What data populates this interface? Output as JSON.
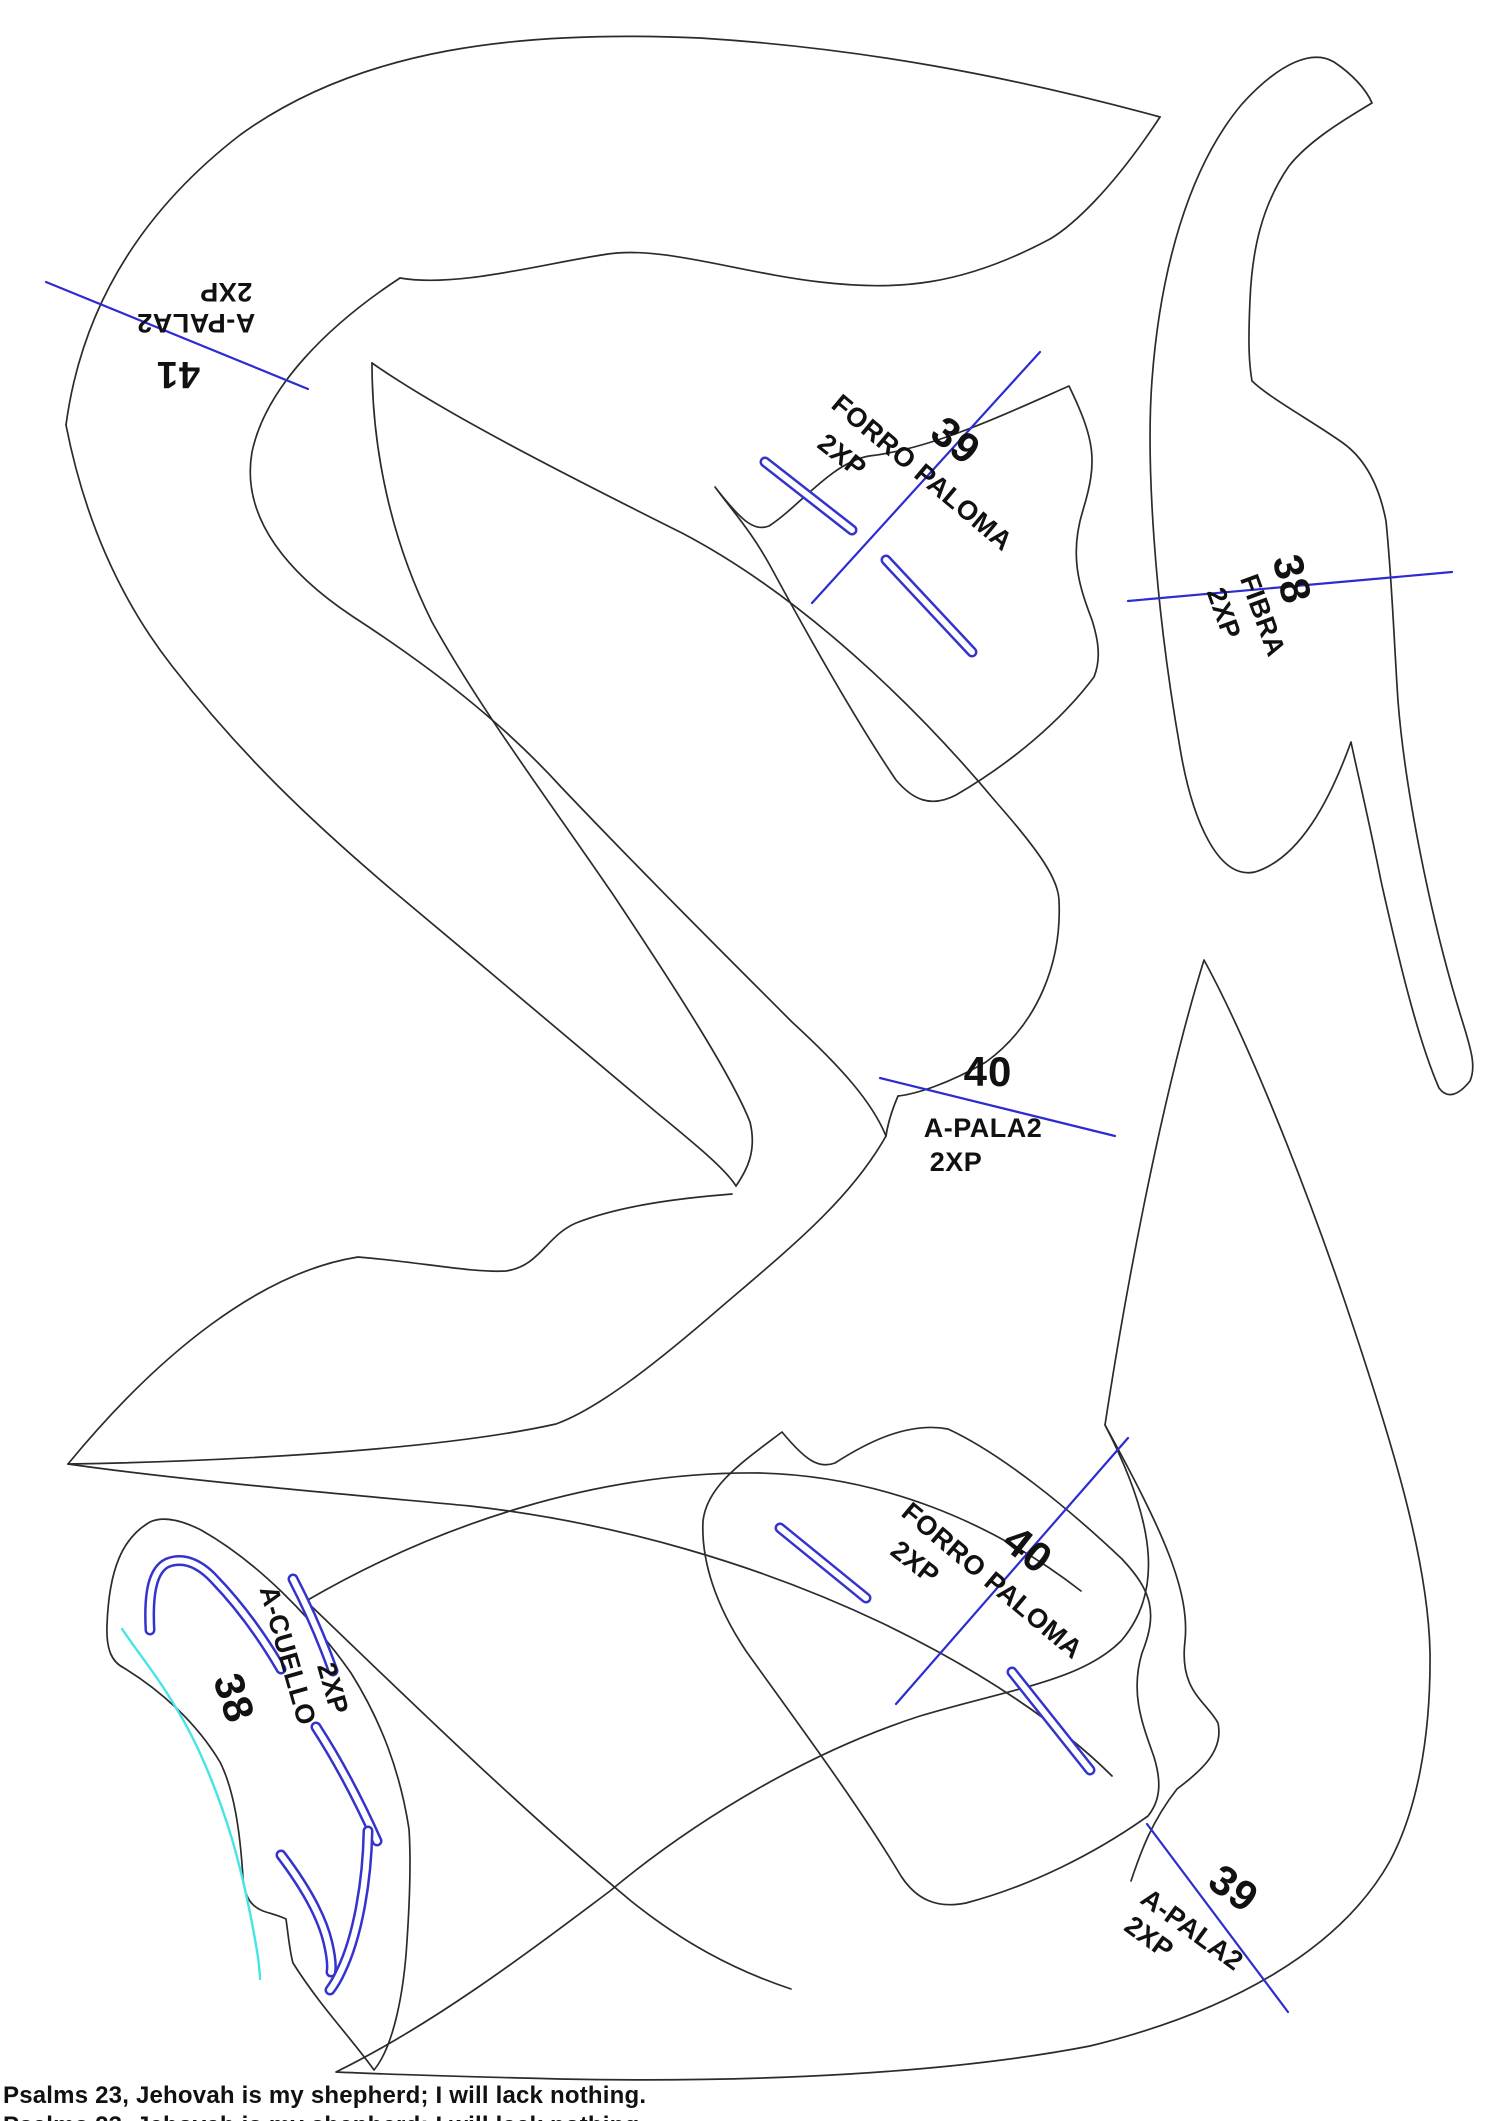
{
  "pieces": [
    {
      "size": "41",
      "name": "A-PALA2",
      "qty": "2XP"
    },
    {
      "size": "39",
      "name": "FORRO PALOMA",
      "qty": "2XP"
    },
    {
      "size": "38",
      "name": "FIBRA",
      "qty": "2XP"
    },
    {
      "size": "40",
      "name": "A-PALA2",
      "qty": "2XP"
    },
    {
      "size": "40",
      "name": "FORRO PALOMA",
      "qty": "2XP"
    },
    {
      "size": "38",
      "name": "A-CUELLO",
      "qty": "2XP"
    },
    {
      "size": "39",
      "name": "A-PALA2",
      "qty": "2XP"
    }
  ],
  "footer": {
    "caption": "Psalms 23, Jehovah is my shepherd; I will lack nothing."
  },
  "colors": {
    "outline": "#2b2b2b",
    "grain": "#2c2cd0",
    "slot": "#3434cc",
    "accent": "#46e4e6",
    "text": "#111111",
    "bg": "#ffffff"
  }
}
